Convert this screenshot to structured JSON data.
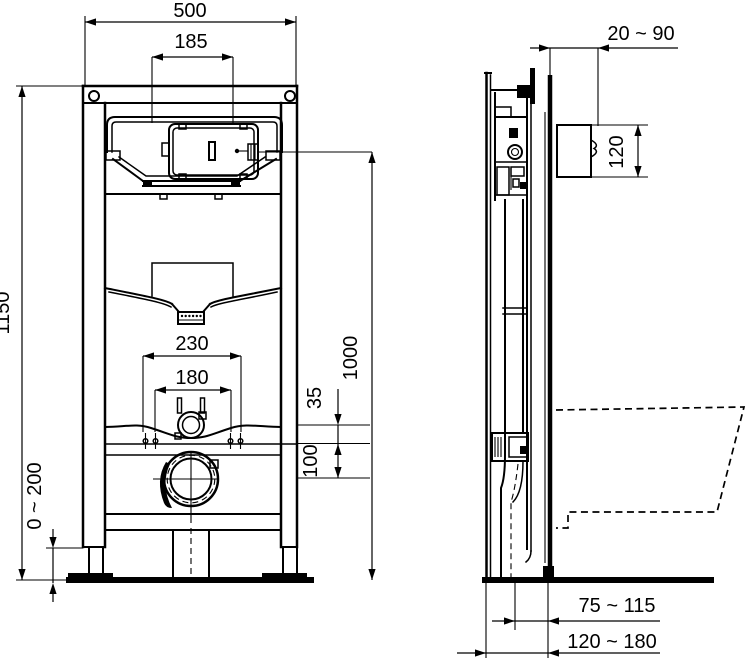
{
  "colors": {
    "ink": "#000000",
    "background": "#ffffff"
  },
  "front_view": {
    "overall_width": "500",
    "flush_plate_cutout_width": "185",
    "overall_height": "1150",
    "fixing_bolt_spacing_outer": "230",
    "fixing_bolt_spacing_inner": "180",
    "plate_to_bolt_offset": "35",
    "bolt_to_outlet_offset": "100",
    "flush_plate_height": "1000",
    "foot_adjustment_range": "0 ~ 200"
  },
  "side_view": {
    "flush_plate_depth_adjustment": "20 ~ 90",
    "flush_plate_opening_height": "120",
    "outlet_centre_to_wall": "75 ~ 115",
    "frame_depth_to_wall": "120 ~ 180"
  }
}
